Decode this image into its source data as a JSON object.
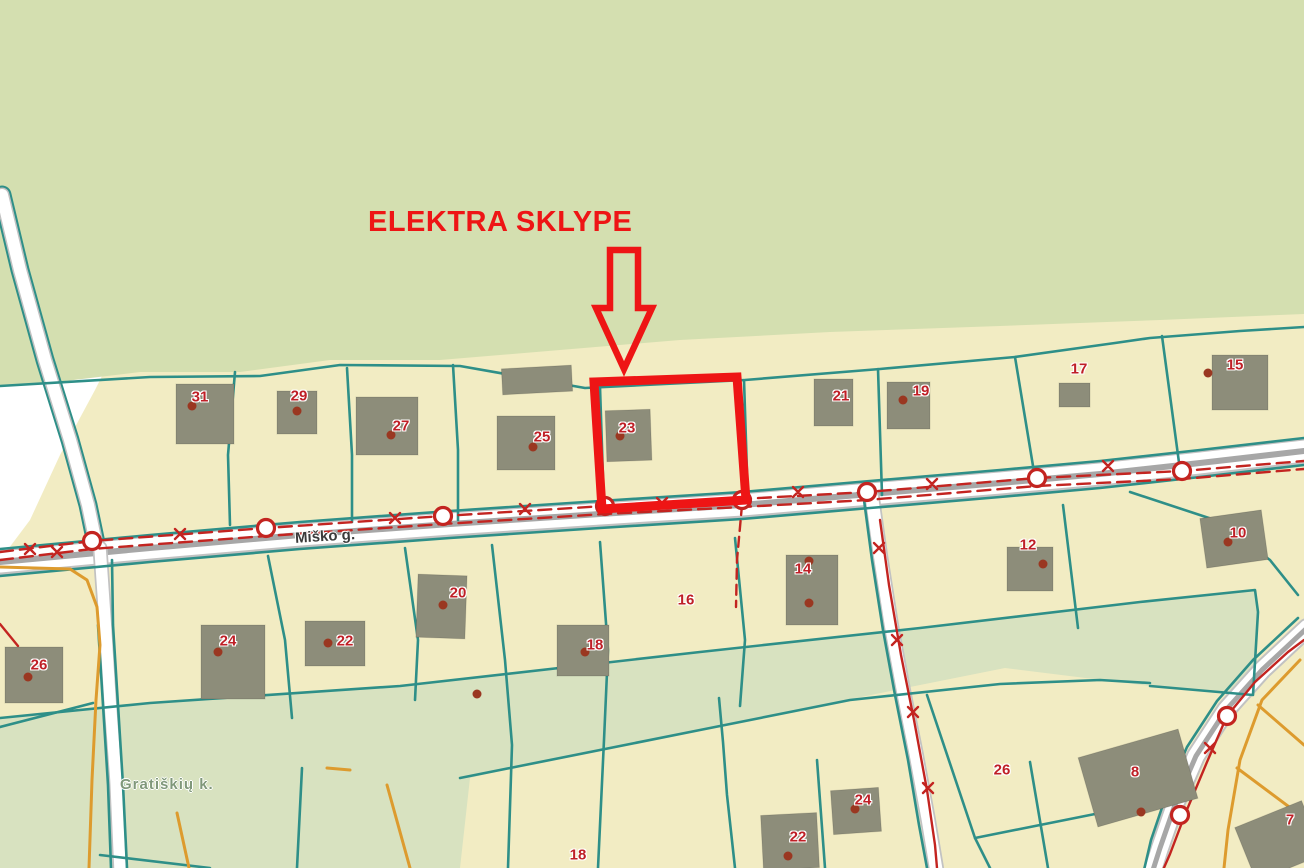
{
  "annotation": {
    "title": "ELEKTRA SKLYPE"
  },
  "map": {
    "street_label": "Miško g.",
    "village_label": "Gratiškių k.",
    "plot_labels": [
      {
        "num": "31",
        "x": 200,
        "y": 397
      },
      {
        "num": "29",
        "x": 299,
        "y": 396
      },
      {
        "num": "27",
        "x": 401,
        "y": 426
      },
      {
        "num": "25",
        "x": 542,
        "y": 437
      },
      {
        "num": "23",
        "x": 627,
        "y": 428
      },
      {
        "num": "21",
        "x": 841,
        "y": 396
      },
      {
        "num": "19",
        "x": 921,
        "y": 391
      },
      {
        "num": "17",
        "x": 1079,
        "y": 369
      },
      {
        "num": "15",
        "x": 1235,
        "y": 365
      },
      {
        "num": "10",
        "x": 1238,
        "y": 533
      },
      {
        "num": "12",
        "x": 1028,
        "y": 545
      },
      {
        "num": "14",
        "x": 803,
        "y": 569
      },
      {
        "num": "16",
        "x": 686,
        "y": 600
      },
      {
        "num": "18",
        "x": 595,
        "y": 645
      },
      {
        "num": "20",
        "x": 458,
        "y": 593
      },
      {
        "num": "22",
        "x": 345,
        "y": 641
      },
      {
        "num": "24",
        "x": 228,
        "y": 641
      },
      {
        "num": "26",
        "x": 39,
        "y": 665
      },
      {
        "num": "26",
        "x": 1002,
        "y": 770
      },
      {
        "num": "8",
        "x": 1135,
        "y": 772
      },
      {
        "num": "24",
        "x": 863,
        "y": 800
      },
      {
        "num": "22",
        "x": 798,
        "y": 837
      },
      {
        "num": "18",
        "x": 578,
        "y": 855
      },
      {
        "num": "7",
        "x": 1290,
        "y": 820
      }
    ],
    "colors": {
      "forest": "#d4dfb0",
      "band": "#d8e2c0",
      "parcel": "#f2ecc3",
      "building": "#8d8d7a",
      "boundary": "#2e8f88",
      "power": "#c32420",
      "highlight": "#ee1515",
      "orange": "#dd9b2e",
      "road_core": "#a7a7a7",
      "road_casing": "#c2c2c2",
      "number": "#bf1f26",
      "street_text": "#3a3a3a",
      "village_text": "#80987a"
    }
  }
}
